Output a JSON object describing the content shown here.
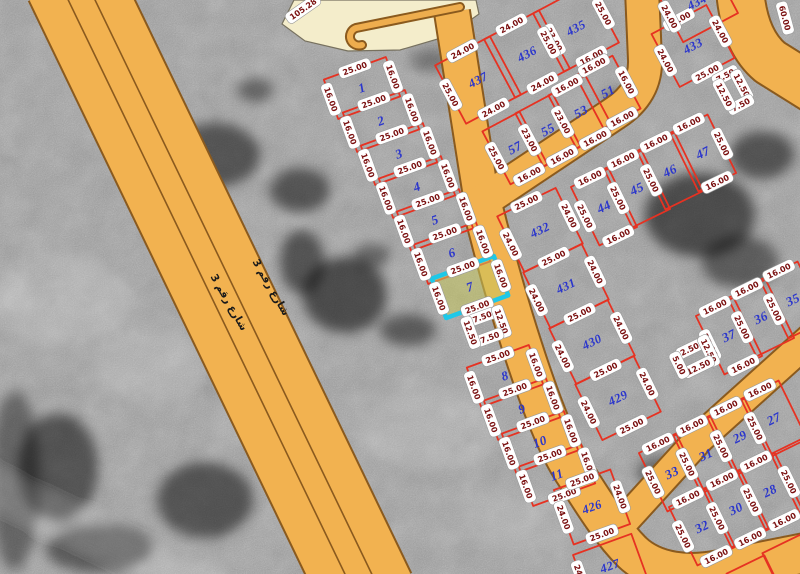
{
  "map": {
    "background_color": "#a0a0a0",
    "road_fill": "#f2b250",
    "road_casing": "#8a5a1e",
    "plaza_fill": "#f4edcb",
    "plaza_stroke": "#77715f",
    "parcel_line_color": "#e63222",
    "parcel_number_color": "#2b36cc",
    "dim_text_color": "#7a1010",
    "pill_fill": "#ffffff",
    "pill_stroke": "#999999",
    "highlight_stroke": "#1ec8e8",
    "highlight_fill": "rgba(198,198,92,0.55)",
    "street_text_color": "#1a1a1a"
  },
  "blocks": [
    {
      "au": -20,
      "av": 70
    },
    {
      "au": -28,
      "av": 62
    },
    {
      "au": -26,
      "av": 64
    },
    {
      "au": -28,
      "av": 62
    },
    {
      "au": -26,
      "av": 64
    },
    {
      "au": -26,
      "av": 64
    },
    {
      "au": -26,
      "av": 64
    }
  ],
  "roads": [
    {
      "name": "main-street",
      "path": "M 72,-20 L 368,594",
      "width": 94
    },
    {
      "name": "collector-north",
      "path": "M 452,12 L 481,196",
      "width": 34
    },
    {
      "name": "collector-northeast",
      "path": "M 477,205 L 615,113 Q 646,93 645,60 L 642,-10",
      "width": 32
    },
    {
      "name": "collector-south",
      "path": "M 479,192 C 500,280 542,425 574,472 C 592,500 610,530 632,552 C 655,574 690,576 720,570 L 820,550",
      "width": 38
    },
    {
      "name": "southeast-diagonal-street",
      "path": "M 618,528 L 700,438 L 820,330",
      "width": 28
    },
    {
      "name": "right-top-street",
      "path": "M 740,-10 Q 744,40 770,62 L 818,92",
      "width": 46
    }
  ],
  "road_medians": [
    {
      "path": "M 61,-15 L 357,599"
    },
    {
      "path": "M 83,-25 L 379,589"
    }
  ],
  "plaza": {
    "path": "M 282,24 L 294,0 L 476,0 L 479,14 L 448,36 L 400,50 L 348,51 L 305,41 Z",
    "hook_path": "M 460,7 L 356,28 A 9,9 0 1 0 362,45"
  },
  "street_labels": [
    {
      "text": "شارع رقم 3",
      "x": 268,
      "y": 289,
      "rot": 60
    },
    {
      "text": "شارع رقم 3",
      "x": 226,
      "y": 304,
      "rot": 60
    }
  ],
  "extra_labels": [
    {
      "text": "105.28",
      "x": 303,
      "y": 9,
      "rot": -35
    },
    {
      "text": "60.00",
      "x": 785,
      "y": 18,
      "rot": 75
    }
  ],
  "parcels": [
    {
      "b": 0,
      "num": "1",
      "cx": 362,
      "cy": 88,
      "w": 66,
      "h": 42,
      "dims": {
        "top": "25.00",
        "left": "16.00",
        "right": "16.00"
      }
    },
    {
      "b": 0,
      "num": "2",
      "cx": 381,
      "cy": 121,
      "w": 66,
      "h": 42,
      "dims": {
        "top": "25.00",
        "left": "16.00",
        "right": "16.00"
      }
    },
    {
      "b": 0,
      "num": "3",
      "cx": 399,
      "cy": 154,
      "w": 66,
      "h": 42,
      "dims": {
        "top": "25.00",
        "left": "16.00",
        "right": "16.00"
      }
    },
    {
      "b": 0,
      "num": "4",
      "cx": 417,
      "cy": 187,
      "w": 66,
      "h": 42,
      "dims": {
        "top": "25.00",
        "left": "16.00",
        "right": "16.00"
      }
    },
    {
      "b": 0,
      "num": "5",
      "cx": 435,
      "cy": 220,
      "w": 66,
      "h": 42,
      "dims": {
        "top": "25.00",
        "left": "16.00",
        "right": "16.00"
      }
    },
    {
      "b": 0,
      "num": "6",
      "cx": 452,
      "cy": 253,
      "w": 66,
      "h": 42,
      "dims": {
        "top": "25.00",
        "left": "16.00",
        "right": "16.00"
      }
    },
    {
      "b": 0,
      "num": "7",
      "cx": 470,
      "cy": 287,
      "w": 66,
      "h": 42,
      "highlight": true,
      "dims": {
        "top": "25.00",
        "left": "16.00",
        "right": "16.00",
        "bottom": "25.00"
      }
    },
    {
      "b": 0,
      "num": "",
      "cx": 486,
      "cy": 327,
      "w": 33,
      "h": 22,
      "dims": {
        "top": "7.50",
        "left": "12.50",
        "right": "12.50",
        "bottom": "7.50"
      }
    },
    {
      "b": 0,
      "num": "8",
      "cx": 505,
      "cy": 376,
      "w": 66,
      "h": 42,
      "dims": {
        "top": "25.00",
        "left": "16.00",
        "right": "16.00"
      }
    },
    {
      "b": 0,
      "num": "9",
      "cx": 522,
      "cy": 409,
      "w": 66,
      "h": 42,
      "dims": {
        "top": "25.00",
        "left": "16.00",
        "right": "16.00"
      }
    },
    {
      "b": 0,
      "num": "10",
      "cx": 540,
      "cy": 442,
      "w": 66,
      "h": 42,
      "dims": {
        "top": "25.00",
        "left": "16.00",
        "right": "16.00"
      }
    },
    {
      "b": 0,
      "num": "11",
      "cx": 557,
      "cy": 475,
      "w": 66,
      "h": 42,
      "dims": {
        "top": "25.00",
        "left": "16.00",
        "right": "16.00",
        "bottom": "25.00"
      }
    },
    {
      "b": 0,
      "num": "426",
      "cx": 592,
      "cy": 507,
      "w": 60,
      "h": 58,
      "dims": {
        "top": "25.00",
        "left": "24.00",
        "right": "24.00",
        "bottom": "25.00"
      }
    },
    {
      "b": 0,
      "num": "427",
      "cx": 610,
      "cy": 566,
      "w": 62,
      "h": 46,
      "dims": {
        "left": "24.00",
        "bottom": "25.00"
      }
    },
    {
      "b": 1,
      "num": "437",
      "cx": 478,
      "cy": 80,
      "w": 62,
      "h": 66,
      "dims": {
        "top": "24.00",
        "left": "25.00",
        "bottom": "24.00"
      }
    },
    {
      "b": 1,
      "num": "436",
      "cx": 527,
      "cy": 54,
      "w": 62,
      "h": 66,
      "dims": {
        "top": "24.00",
        "right": "23.00",
        "bottom": "24.00"
      }
    },
    {
      "b": 1,
      "num": "435",
      "cx": 576,
      "cy": 28,
      "w": 62,
      "h": 66,
      "dims": {
        "left": "25.00",
        "right": "25.00",
        "bottom": "16.00"
      }
    },
    {
      "b": 1,
      "num": "57",
      "cx": 515,
      "cy": 148,
      "w": 42,
      "h": 60,
      "dims": {
        "left": "25.00",
        "bottom": "16.00"
      }
    },
    {
      "b": 1,
      "num": "55",
      "cx": 548,
      "cy": 130,
      "w": 42,
      "h": 60,
      "dims": {
        "left": "23.00",
        "bottom": "16.00"
      }
    },
    {
      "b": 1,
      "num": "53",
      "cx": 581,
      "cy": 112,
      "w": 42,
      "h": 60,
      "dims": {
        "top": "16.00",
        "left": "23.00",
        "bottom": "16.00"
      }
    },
    {
      "b": 1,
      "num": "51",
      "cx": 608,
      "cy": 92,
      "w": 42,
      "h": 60,
      "dims": {
        "top": "16.00",
        "right": "16.00",
        "bottom": "16.00"
      }
    },
    {
      "b": 2,
      "num": "432",
      "cx": 540,
      "cy": 230,
      "w": 65,
      "h": 62,
      "dims": {
        "top": "25.00",
        "left": "24.00",
        "right": "24.00",
        "bottom": "25.00"
      }
    },
    {
      "b": 2,
      "num": "431",
      "cx": 566,
      "cy": 286,
      "w": 65,
      "h": 62,
      "dims": {
        "left": "24.00",
        "right": "24.00",
        "bottom": "25.00"
      }
    },
    {
      "b": 2,
      "num": "430",
      "cx": 592,
      "cy": 342,
      "w": 65,
      "h": 62,
      "dims": {
        "left": "24.00",
        "right": "24.00",
        "bottom": "25.00"
      }
    },
    {
      "b": 2,
      "num": "429",
      "cx": 618,
      "cy": 398,
      "w": 65,
      "h": 62,
      "dims": {
        "left": "24.00",
        "right": "24.00",
        "bottom": "25.00"
      }
    },
    {
      "b": 2,
      "num": "44",
      "cx": 604,
      "cy": 207,
      "w": 42,
      "h": 65,
      "dims": {
        "top": "16.00",
        "left": "25.00",
        "bottom": "16.00"
      }
    },
    {
      "b": 2,
      "num": "45",
      "cx": 637,
      "cy": 189,
      "w": 42,
      "h": 65,
      "dims": {
        "top": "16.00",
        "left": "25.00"
      }
    },
    {
      "b": 2,
      "num": "46",
      "cx": 670,
      "cy": 171,
      "w": 42,
      "h": 65,
      "dims": {
        "top": "16.00",
        "left": "25.00"
      }
    },
    {
      "b": 2,
      "num": "47",
      "cx": 703,
      "cy": 153,
      "w": 42,
      "h": 65,
      "dims": {
        "top": "16.00",
        "right": "25.00",
        "bottom": "16.00"
      }
    },
    {
      "b": 3,
      "num": "433",
      "cx": 693,
      "cy": 46,
      "w": 62,
      "h": 60,
      "dims": {
        "top": "25.00",
        "left": "24.00",
        "right": "24.00",
        "bottom": "25.00"
      }
    },
    {
      "b": 3,
      "num": "434",
      "cx": 697,
      "cy": 2,
      "w": 62,
      "h": 58,
      "dims": {
        "left": "24.00"
      }
    },
    {
      "b": 3,
      "num": "",
      "cx": 733,
      "cy": 90,
      "w": 20,
      "h": 33,
      "dims": {
        "top": "7.50",
        "left": "12.50",
        "right": "12.50",
        "bottom": "7.50"
      }
    },
    {
      "b": 4,
      "num": "37",
      "cx": 729,
      "cy": 336,
      "w": 42,
      "h": 65,
      "dims": {
        "top": "16.00",
        "left": "25.00",
        "bottom": "16.00"
      }
    },
    {
      "b": 4,
      "num": "36",
      "cx": 761,
      "cy": 318,
      "w": 42,
      "h": 65,
      "dims": {
        "top": "16.00",
        "left": "25.00"
      }
    },
    {
      "b": 4,
      "num": "35",
      "cx": 793,
      "cy": 300,
      "w": 42,
      "h": 65,
      "dims": {
        "top": "16.00",
        "left": "25.00"
      }
    },
    {
      "b": 4,
      "num": "",
      "cx": 694,
      "cy": 358,
      "w": 33,
      "h": 20,
      "dims": {
        "top": "2.50",
        "left": "5.00",
        "right": "12.50",
        "bottom": "12.50"
      }
    },
    {
      "b": 5,
      "num": "33",
      "cx": 672,
      "cy": 473,
      "w": 42,
      "h": 65,
      "dims": {
        "top": "16.00",
        "left": "25.00"
      }
    },
    {
      "b": 5,
      "num": "31",
      "cx": 706,
      "cy": 455,
      "w": 42,
      "h": 65,
      "dims": {
        "top": "16.00",
        "left": "25.00"
      }
    },
    {
      "b": 5,
      "num": "29",
      "cx": 740,
      "cy": 437,
      "w": 42,
      "h": 65,
      "dims": {
        "top": "16.00",
        "left": "25.00"
      }
    },
    {
      "b": 5,
      "num": "27",
      "cx": 774,
      "cy": 419,
      "w": 42,
      "h": 65,
      "dims": {
        "top": "16.00",
        "left": "25.00"
      }
    },
    {
      "b": 5,
      "num": "32",
      "cx": 702,
      "cy": 527,
      "w": 42,
      "h": 65,
      "dims": {
        "top": "16.00",
        "left": "25.00",
        "bottom": "16.00"
      }
    },
    {
      "b": 5,
      "num": "30",
      "cx": 736,
      "cy": 509,
      "w": 42,
      "h": 65,
      "dims": {
        "top": "16.00",
        "left": "25.00",
        "bottom": "16.00"
      }
    },
    {
      "b": 5,
      "num": "28",
      "cx": 770,
      "cy": 491,
      "w": 42,
      "h": 65,
      "dims": {
        "top": "16.00",
        "left": "25.00",
        "right": "25.00",
        "bottom": "16.00"
      }
    },
    {
      "b": 5,
      "num": "",
      "cx": 804,
      "cy": 474,
      "w": 42,
      "h": 65,
      "dims": {}
    },
    {
      "b": 6,
      "num": "",
      "cx": 790,
      "cy": 562,
      "w": 42,
      "h": 40,
      "dims": {}
    },
    {
      "b": 6,
      "num": "",
      "cx": 752,
      "cy": 578,
      "w": 42,
      "h": 30,
      "dims": {}
    }
  ]
}
